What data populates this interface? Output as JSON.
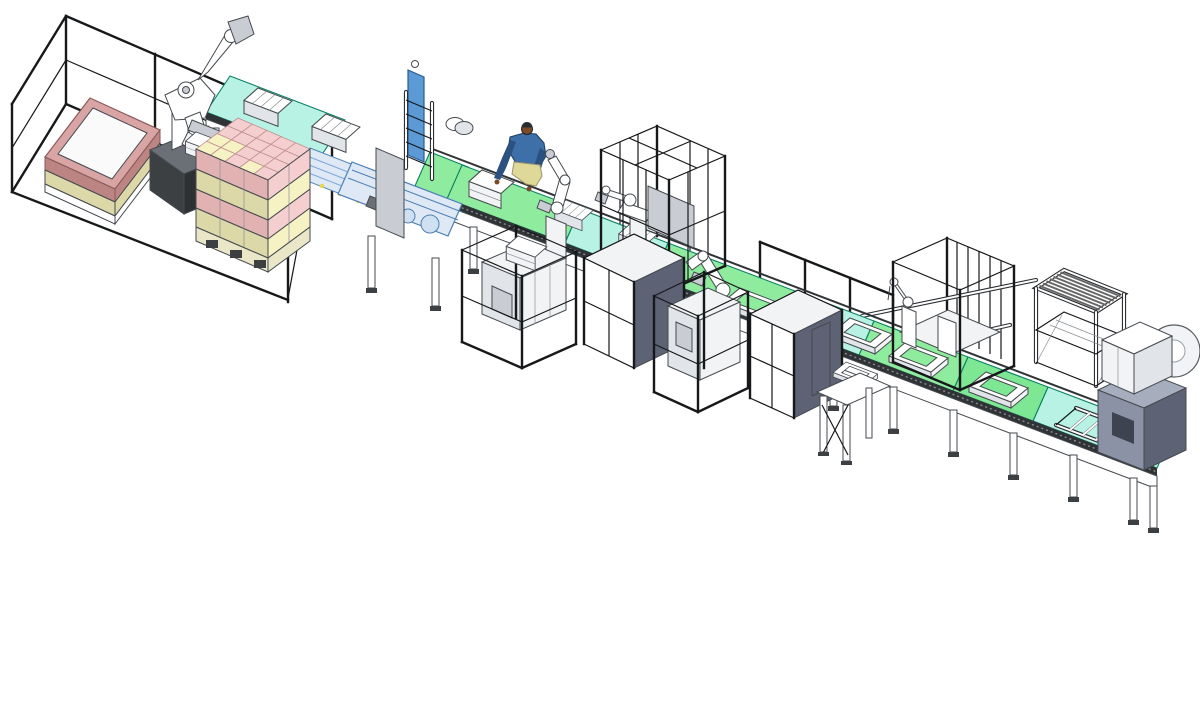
{
  "scene": {
    "type": "3d-cad-render",
    "description": "Isometric 3D CAD model of an automated carton packing and palletizing production line: safety fencing, palletizing robot, loaded pallet, case packer, belt conveyors with cartons and tray carriers, operator figure, inline robots, machine cages, electrical cabinets, robot cell, roller rack and film wrapping machine",
    "colors": {
      "background": "#ffffff",
      "outline": "#16181a",
      "conveyor_cyan": "#b7f2e4",
      "conveyor_green": "#8fec9f",
      "conveyor_green_alt": "#7de793",
      "conveyor_edge": "#0c8063",
      "belt_dark": "#2f3335",
      "machine_blue": "#5c9ad6",
      "machine_blue_light": "#dfe9f5",
      "accent_yellow": "#e8d44d",
      "box_pink": "#f5cfcf",
      "box_pink_side": "#e2b2b2",
      "box_yellow": "#f6f2c4",
      "box_yellow_side": "#ddd8a8",
      "collar_pink": "#d9a4a4",
      "collar_pink_dark": "#bd8484",
      "pallet_wood": "#eae6c8",
      "slate_dark": "#5d6375",
      "machine_body_gray": "#8b92a6",
      "machine_body_top": "#a6adbd",
      "robot_base_dark": "#2e3134",
      "human_blue": "#3d6fa8",
      "human_blue_dark": "#2a517f",
      "human_skin": "#7a4a2a",
      "human_pants": "#ded998",
      "roll_face": "#f2f3f6"
    },
    "pallet_stack": {
      "cells": [
        [
          "#f5cfcf",
          "#f5cfcf",
          "#f5cfcf",
          "#f5cfcf",
          "#f5cfcf"
        ],
        [
          "#f5cfcf",
          "#f5cfcf",
          "#f5cfcf",
          "#f5cfcf",
          "#f5cfcf"
        ],
        [
          "#f6f2c4",
          "#f6f2c4",
          "#f5cfcf",
          "#f5cfcf",
          "#f5cfcf"
        ],
        [
          "#f6f2c4",
          "#f6f2c4",
          "#f5cfcf",
          "#f6f2c4",
          "#f5cfcf"
        ]
      ]
    },
    "components": [
      {
        "id": "safety-fence",
        "label": "perimeter safety fence"
      },
      {
        "id": "empty-pallet-collar",
        "label": "empty pallet with pink collar"
      },
      {
        "id": "palletizing-robot",
        "label": "6-axis palletizing robot"
      },
      {
        "id": "loaded-pallet",
        "label": "pallet stacked with pink and yellow cartons"
      },
      {
        "id": "infeed-conveyor",
        "label": "elevated infeed belt conveyor"
      },
      {
        "id": "case-packer",
        "label": "case packing machine"
      },
      {
        "id": "main-conveyor",
        "label": "main belt conveyor line"
      },
      {
        "id": "operator",
        "label": "operator figure"
      },
      {
        "id": "inline-robots",
        "label": "inline pick robots"
      },
      {
        "id": "central-cage",
        "label": "central safety cage"
      },
      {
        "id": "machine-cages",
        "label": "caged process machines"
      },
      {
        "id": "cabinets",
        "label": "electrical cabinets"
      },
      {
        "id": "robot-cell",
        "label": "robot cell with base plate"
      },
      {
        "id": "roller-rack",
        "label": "roller buffer rack"
      },
      {
        "id": "wrapping-machine",
        "label": "film wrapping machine with film roll"
      },
      {
        "id": "work-table",
        "label": "work table"
      },
      {
        "id": "tray-carriers",
        "label": "tray carriers on belt"
      }
    ]
  }
}
